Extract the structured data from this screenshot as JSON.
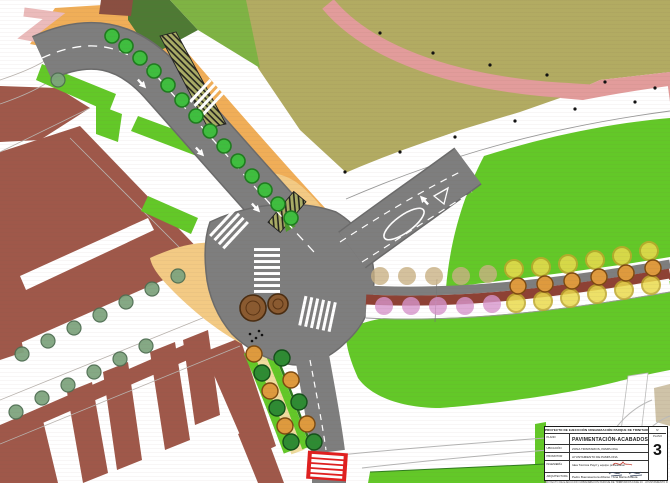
{
  "title_block": {
    "project_header": "PROYECTO DE EJECUCIÓN URBANIZACIÓN PARQUE DE TRINITARIOS FASE 2C",
    "corner_header": "Nº",
    "rows": {
      "plano_label": "PLANO",
      "plano_value": "PAVIMENTACIÓN-ACABADOS",
      "ubicacion_label": "UBICACIÓN",
      "ubicacion_value": "ZONA TRINITARIOS, PAMPLONA",
      "promotor_label": "PROMOTOR",
      "promotor_value": "AYUNTAMIENTO DE PAMPLONA",
      "ingenieria_label": "INGENIERÍA",
      "ingenieria_value": "Idea Técnica Payrl y equipo profesional",
      "arquitectura_label": "ARQUITECTURA",
      "arquitectura_value": "Pedro Buenaventura Alfonso - Ana María Zubieta"
    },
    "sheet_label": "PLANO",
    "sheet_number": "3",
    "footer_note": "PROYECTO DE EJECUCIÓN URBANIZACIÓN PARQUE DE TRINITARIOS FASE 2C · AYUNTAMIENTO DE PAMPLONA"
  },
  "colors": {
    "lawn": "#63C828",
    "olive": "#B2AB62",
    "building": "#9F584A",
    "building_dark": "#8A4F41",
    "road": "#7E7E7E",
    "road_edge": "#6B6B6B",
    "sidewalk": "#F0AE58",
    "plaza": "#F3CA84",
    "path_cream": "#EFDC9E",
    "pink_path": "#E29C9B",
    "pink_ramp": "#EBBBBB",
    "bike_lane": "#8E4134",
    "crossing_red": "#E01F1F",
    "tree_bright": "#3FBE3F",
    "tree_bright_edge": "#1E7C1E",
    "tree_sage": "#7FA57F",
    "tree_dark": "#2E8B33",
    "tree_orange": "#DE9A3E",
    "tree_pink": "#D795CC",
    "tree_tan": "#C9B185",
    "tree_yellow": "#EBDB4E",
    "tree_yellow_edge": "#BFA92C",
    "tree_brown": "#8A5A30",
    "beige_patch": "#CFC3A8"
  }
}
